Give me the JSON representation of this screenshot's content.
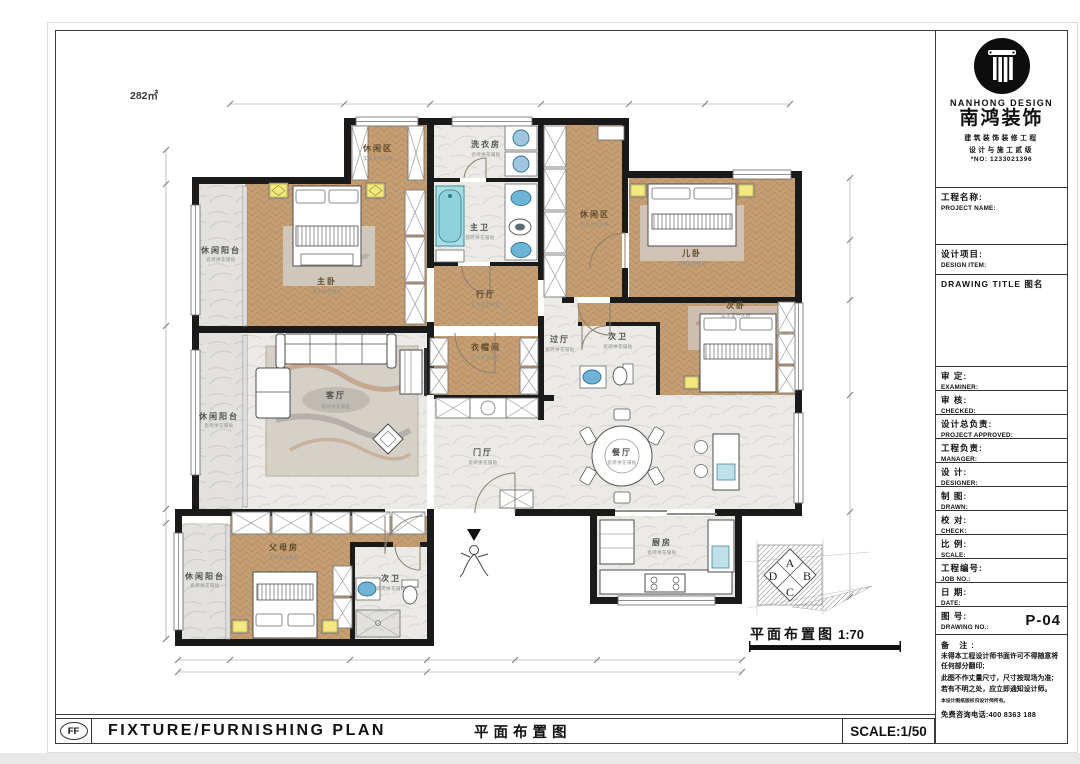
{
  "plan": {
    "area": "282㎡",
    "caption": "平面布置图",
    "scale": "1:70",
    "zone": {
      "a": "A",
      "b": "B",
      "c": "C",
      "d": "D"
    }
  },
  "rooms": {
    "master": {
      "label": "主卧",
      "sub": "实木复合地板"
    },
    "leisure_tl": {
      "label": "休闲区",
      "sub": "实木复合地板"
    },
    "balcony_tl": {
      "label": "休闲阳台",
      "sub": "瓷砖拼花铺贴"
    },
    "laundry": {
      "label": "洗衣房",
      "sub": "瓷砖拼花铺贴"
    },
    "master_bath": {
      "label": "主卫",
      "sub": "瓷砖拼花铺贴"
    },
    "hall_master": {
      "label": "行厅",
      "sub": "实木复合地板"
    },
    "leisure_tr": {
      "label": "休闲区",
      "sub": "实木复合地板"
    },
    "child_bed": {
      "label": "儿卧",
      "sub": "实木复合地板"
    },
    "second_bed": {
      "label": "次卧",
      "sub": "实木复合地板"
    },
    "hall_mid": {
      "label": "过厅",
      "sub": "瓷砖拼花铺贴"
    },
    "bath_mid": {
      "label": "次卫",
      "sub": "瓷砖拼花铺贴"
    },
    "cloakroom": {
      "label": "衣帽间",
      "sub": "实木复合地板"
    },
    "living": {
      "label": "客厅",
      "sub": "瓷砖拼花铺贴"
    },
    "balcony_ml": {
      "label": "休闲阳台",
      "sub": "瓷砖拼花铺贴"
    },
    "entry": {
      "label": "门厅",
      "sub": "瓷砖拼花铺贴"
    },
    "dining": {
      "label": "餐厅",
      "sub": "瓷砖拼花铺贴"
    },
    "kitchen": {
      "label": "厨房",
      "sub": "瓷砖拼花铺贴"
    },
    "parents": {
      "label": "父母房",
      "sub": "实木复合地板"
    },
    "bath_btm": {
      "label": "次卫",
      "sub": "瓷砖拼花铺贴"
    },
    "balcony_bl": {
      "label": "休闲阳台",
      "sub": "瓷砖拼花铺贴"
    }
  },
  "logo": {
    "brand_en": "NANHONG DESIGN",
    "brand_cn": "南鸿装饰",
    "sub1": "建筑装饰装修工程",
    "sub2": "设计与施工贰级",
    "reg_no": "*NO: 1233021396"
  },
  "titleblock": {
    "project": {
      "cn": "工程名称:",
      "en": "PROJECT NAME:"
    },
    "design_item": {
      "cn": "设计项目:",
      "en": "DESIGN ITEM:"
    },
    "drawing_title_label": "DRAWING TITLE 图名",
    "fields": [
      {
        "cn": "审  定:",
        "en": "EXAMINER:"
      },
      {
        "cn": "审  核:",
        "en": "CHECKED:"
      },
      {
        "cn": "设计总负责:",
        "en": "PROJECT APPROVED:"
      },
      {
        "cn": "工程负责:",
        "en": "MANAGER:"
      },
      {
        "cn": "设  计:",
        "en": "DESIGNER:"
      },
      {
        "cn": "制  图:",
        "en": "DRAWN:"
      },
      {
        "cn": "校  对:",
        "en": "CHECK:"
      },
      {
        "cn": "比  例:",
        "en": "SCALE:"
      },
      {
        "cn": "工程编号:",
        "en": "JOB NO.:"
      },
      {
        "cn": "日  期:",
        "en": "DATE:"
      }
    ],
    "drawing_no": {
      "cn": "图  号:",
      "en": "DRAWING NO.:",
      "value": "P-04"
    },
    "notes": {
      "title": "备  注:",
      "lines": [
        "未得本工程设计师书面许可不得随意将任何部分翻印;",
        "此图不作丈量尺寸，尺寸按现场为准;",
        "若有不明之处，应立即通知设计师。"
      ],
      "fine": "本设计图纸版权归设计师所有。",
      "phone": "免费咨询电话:400 8363 188"
    }
  },
  "footer": {
    "code": "FF",
    "title_en": "FIXTURE/FURNISHING PLAN",
    "title_cn": "平面布置图",
    "scale": "SCALE:1/50"
  }
}
